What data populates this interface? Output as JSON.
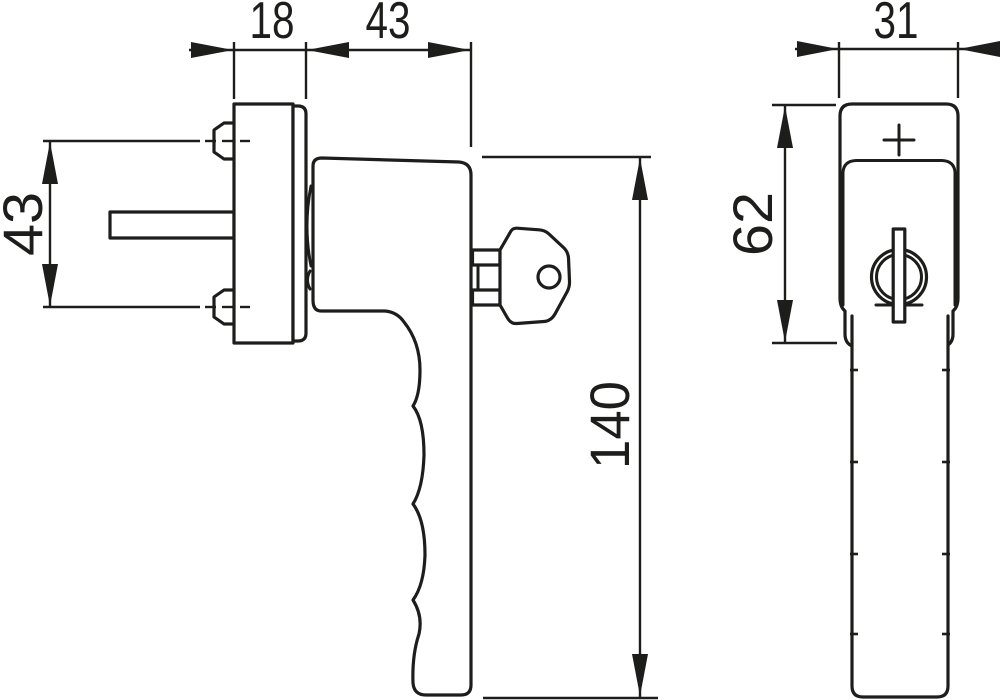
{
  "background": "#ffffff",
  "line_color": "#1d1d1b",
  "side_view": {
    "dim_plate_depth": "18",
    "dim_head_depth": "43",
    "dim_screw_spacing": "43",
    "dim_total_length": "140"
  },
  "front_view": {
    "dim_width": "31",
    "dim_base_height": "62"
  },
  "icons": {
    "key": "key-icon",
    "lock_cylinder": "lock-cylinder-icon",
    "plus_mark": "plus-mark-icon",
    "screw": "screw-icon"
  }
}
